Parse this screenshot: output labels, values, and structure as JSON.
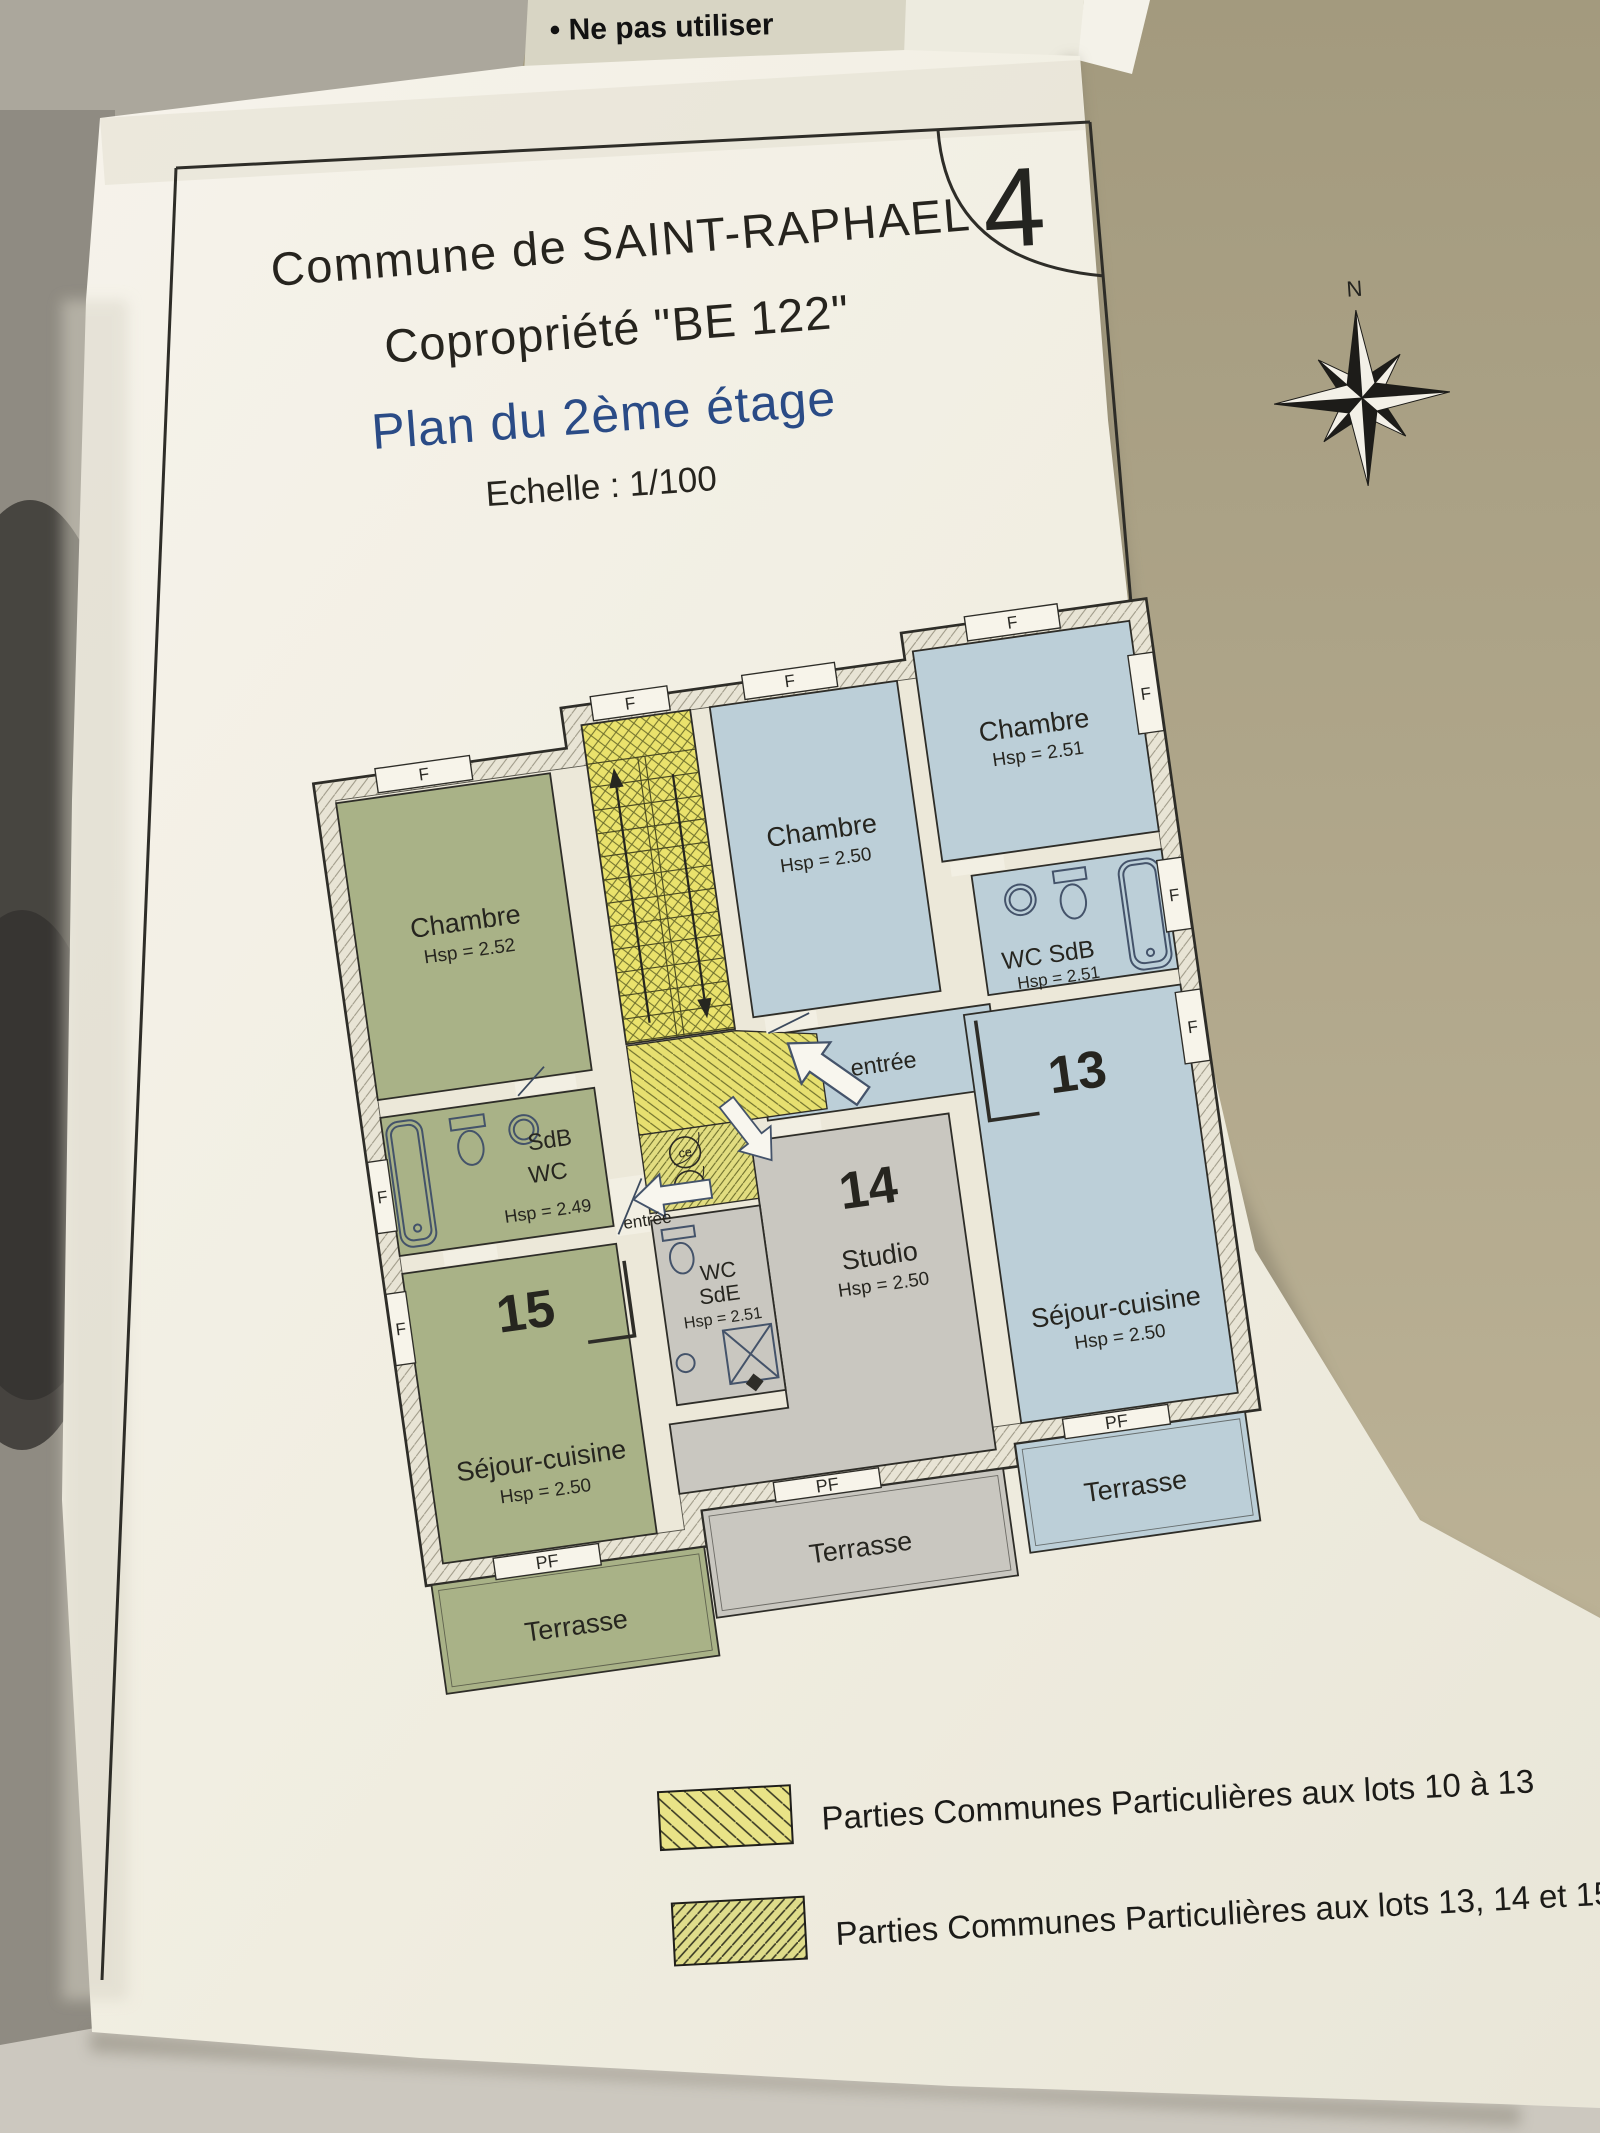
{
  "scene": {
    "background_document": {
      "line1": "• Ne pas utiliser",
      "line2": "chargeur"
    },
    "page_number": "4"
  },
  "title_block": {
    "commune": "Commune de SAINT-RAPHAEL",
    "copropriete": "Copropriété \"BE 122\"",
    "plan_title": "Plan du 2ème étage",
    "echelle": "Echelle : 1/100"
  },
  "compass": {
    "north_label": "N"
  },
  "plan": {
    "lot15": {
      "number": "15",
      "chambre": "Chambre",
      "chambre_hsp": "Hsp = 2.52",
      "sdb": "SdB",
      "wc": "WC",
      "sdb_hsp": "Hsp = 2.49",
      "sejour": "Séjour-cuisine",
      "sejour_hsp": "Hsp = 2.50",
      "terrasse": "Terrasse",
      "entree": "entrée"
    },
    "lot14": {
      "number": "14",
      "wc": "WC",
      "sde": "SdE",
      "wc_hsp": "Hsp = 2.51",
      "studio": "Studio",
      "studio_hsp": "Hsp = 2.50",
      "terrasse": "Terrasse"
    },
    "lot13": {
      "number": "13",
      "chambre1": "Chambre",
      "chambre1_hsp": "Hsp = 2.50",
      "chambre2": "Chambre",
      "chambre2_hsp": "Hsp = 2.51",
      "wc_sdb": "WC SdB",
      "wc_sdb_hsp": "Hsp = 2.51",
      "sejour": "Séjour-cuisine",
      "sejour_hsp": "Hsp = 2.50",
      "terrasse": "Terrasse",
      "entree": "entrée"
    },
    "symbols": {
      "window": "F",
      "french_window": "PF",
      "duct": "ce"
    }
  },
  "legend": {
    "item1": "Parties Communes Particulières aux lots 10 à 13",
    "item2": "Parties Communes Particulières aux lots 13, 14 et 15"
  },
  "colors": {
    "lot15_green": "#a9b287",
    "lot13_blue": "#bccfd8",
    "lot14_grey": "#c9c7c0",
    "common_yellow": "#eae26c",
    "plan_title_blue": "#2a4b86"
  }
}
